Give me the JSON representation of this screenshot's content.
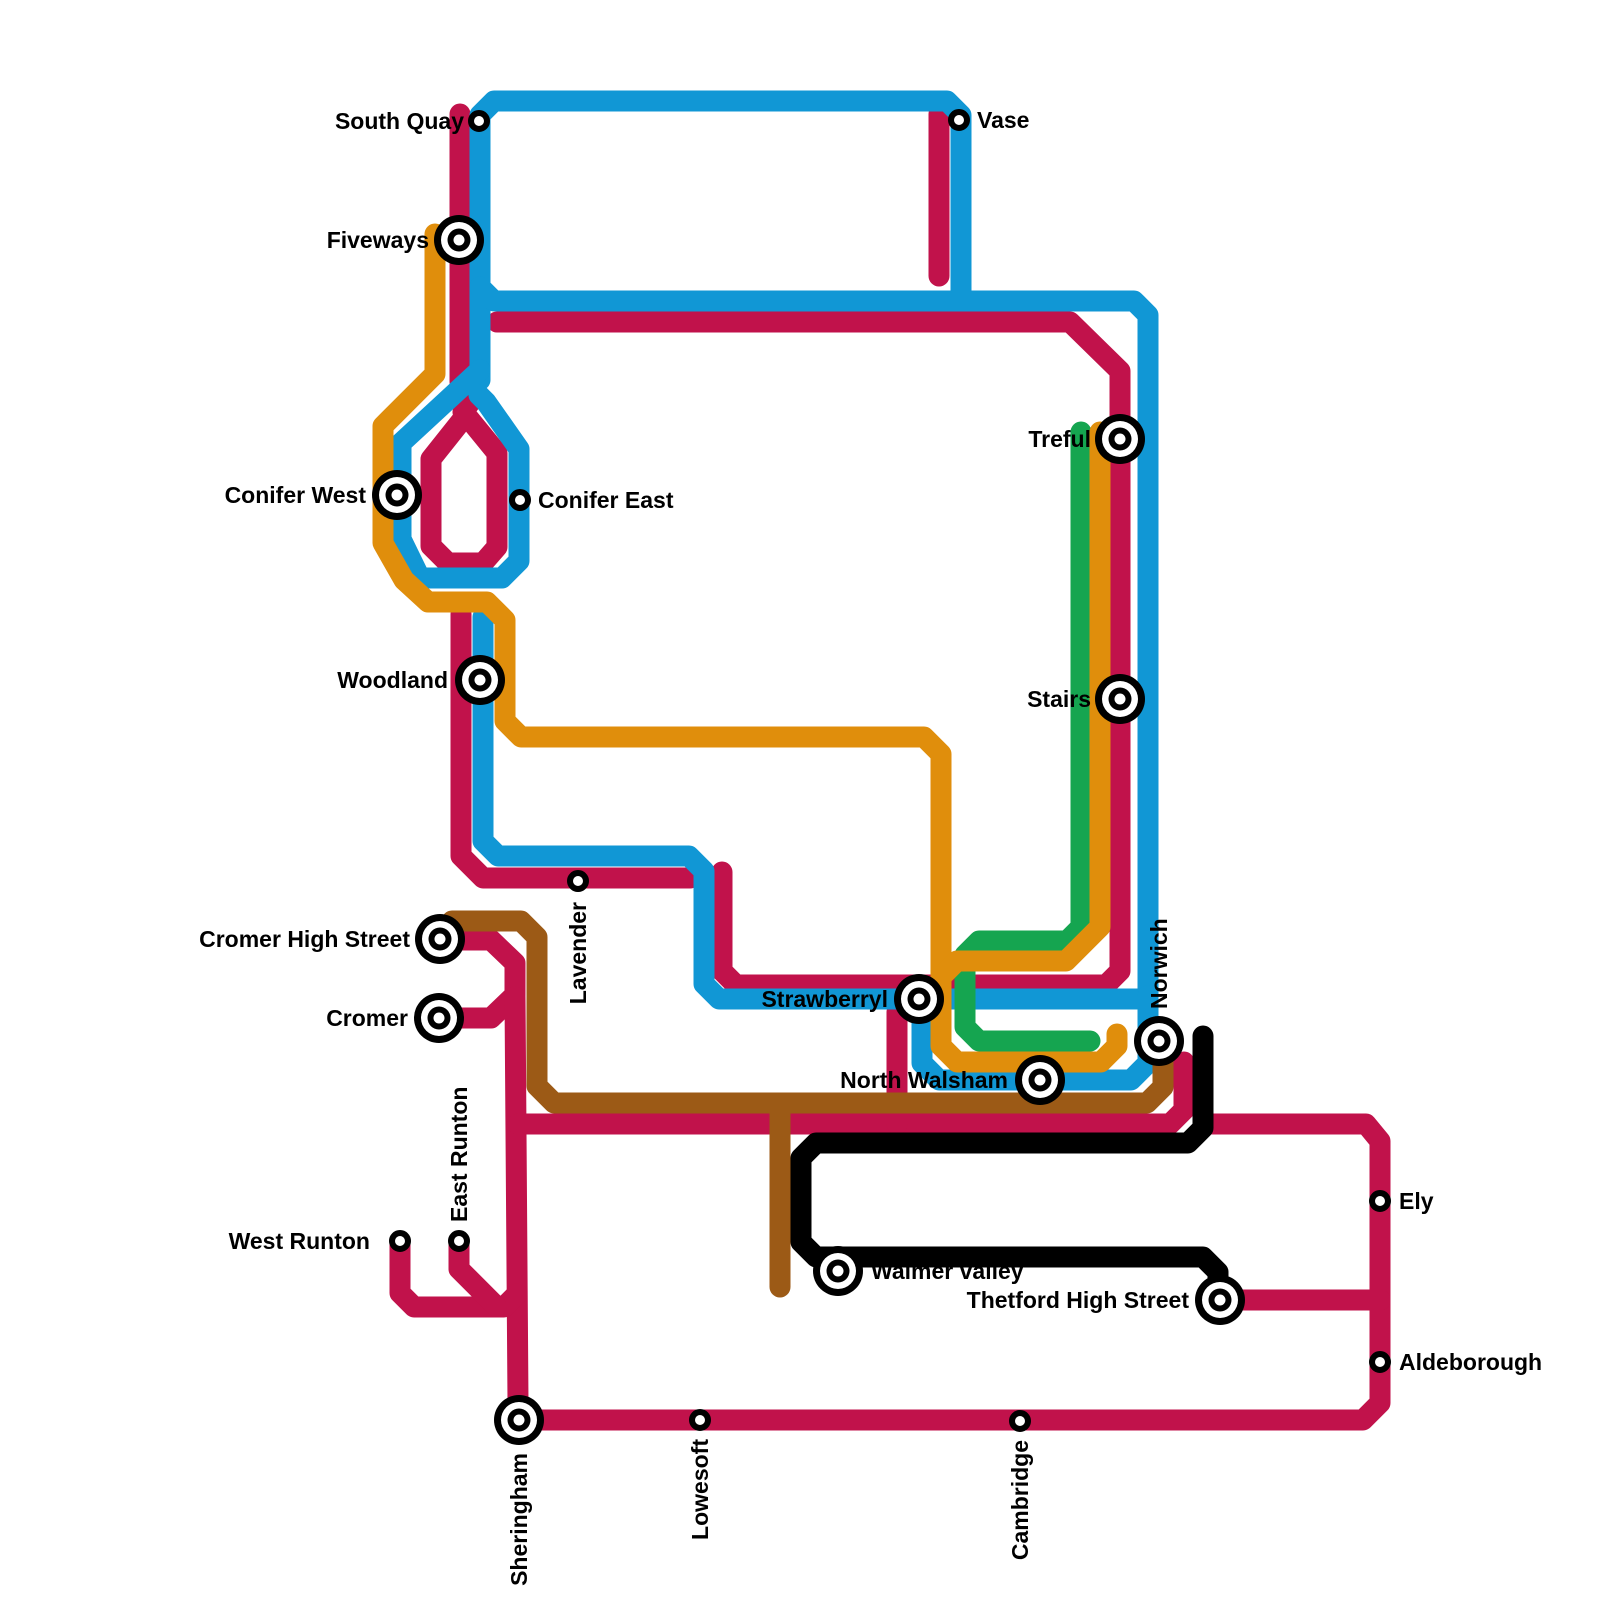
{
  "map": {
    "canvas": {
      "width": 1600,
      "height": 1600,
      "background": "#ffffff"
    },
    "line_width": 21,
    "label_font_size": 23,
    "colors": {
      "crimson": "#C1124B",
      "blue": "#1197D5",
      "orange": "#E08E0C",
      "green": "#15A550",
      "brown": "#9C5A16",
      "black": "#000000"
    },
    "lines": [
      {
        "name": "crimson-southquay-feed",
        "color": "crimson",
        "closed": false,
        "points": [
          [
            460,
            114
          ],
          [
            460,
            382
          ],
          [
            469,
            393
          ],
          [
            469,
            404
          ],
          [
            463,
            412
          ]
        ]
      },
      {
        "name": "crimson-conifer-loop",
        "color": "crimson",
        "closed": true,
        "points": [
          [
            466,
            415
          ],
          [
            497,
            453
          ],
          [
            497,
            547
          ],
          [
            483,
            563
          ],
          [
            448,
            563
          ],
          [
            431,
            546
          ],
          [
            431,
            459
          ]
        ]
      },
      {
        "name": "crimson-treful-strawberry",
        "color": "crimson",
        "closed": false,
        "points": [
          [
            497,
            322
          ],
          [
            1070,
            322
          ],
          [
            1120,
            371
          ],
          [
            1120,
            971
          ],
          [
            1106,
            985
          ],
          [
            736,
            985
          ],
          [
            722,
            971
          ],
          [
            722,
            872
          ]
        ]
      },
      {
        "name": "crimson-woodland-lavender",
        "color": "crimson",
        "closed": false,
        "points": [
          [
            461,
            614
          ],
          [
            461,
            856
          ],
          [
            483,
            878
          ],
          [
            690,
            878
          ]
        ]
      },
      {
        "name": "crimson-cromer-v",
        "color": "crimson",
        "closed": false,
        "points": [
          [
            446,
            940
          ],
          [
            491,
            940
          ],
          [
            515,
            963
          ],
          [
            515,
            995
          ],
          [
            491,
            1018
          ],
          [
            446,
            1018
          ]
        ]
      },
      {
        "name": "crimson-grand-loop",
        "color": "crimson",
        "closed": false,
        "points": [
          [
            515,
            997
          ],
          [
            518,
            1403
          ],
          [
            534,
            1420
          ],
          [
            1363,
            1420
          ],
          [
            1380,
            1403
          ],
          [
            1380,
            1141
          ],
          [
            1366,
            1124
          ],
          [
            1213,
            1124
          ]
        ]
      },
      {
        "name": "crimson-norwich-branch",
        "color": "crimson",
        "closed": false,
        "points": [
          [
            518,
            1124
          ],
          [
            1170,
            1124
          ],
          [
            1184,
            1110
          ],
          [
            1184,
            1062
          ]
        ]
      },
      {
        "name": "crimson-strawberry-stub",
        "color": "crimson",
        "closed": false,
        "points": [
          [
            897,
            1012
          ],
          [
            897,
            1124
          ]
        ]
      },
      {
        "name": "crimson-vase-stub",
        "color": "crimson",
        "closed": false,
        "points": [
          [
            939,
            114
          ],
          [
            939,
            276
          ]
        ]
      },
      {
        "name": "crimson-west-runton",
        "color": "crimson",
        "closed": false,
        "points": [
          [
            400,
            1241
          ],
          [
            400,
            1293
          ],
          [
            414,
            1307
          ],
          [
            504,
            1307
          ],
          [
            517,
            1294
          ]
        ]
      },
      {
        "name": "crimson-east-runton",
        "color": "crimson",
        "closed": false,
        "points": [
          [
            459,
            1241
          ],
          [
            459,
            1269
          ],
          [
            496,
            1306
          ]
        ]
      },
      {
        "name": "crimson-thetford-east",
        "color": "crimson",
        "closed": false,
        "points": [
          [
            1222,
            1300
          ],
          [
            1380,
            1300
          ]
        ]
      },
      {
        "name": "blue-top-rectangle",
        "color": "blue",
        "closed": false,
        "points": [
          [
            480,
            380
          ],
          [
            480,
            115
          ],
          [
            494,
            101
          ],
          [
            947,
            101
          ],
          [
            961,
            115
          ],
          [
            961,
            293
          ]
        ]
      },
      {
        "name": "blue-cross-town",
        "color": "blue",
        "closed": false,
        "points": [
          [
            480,
            287
          ],
          [
            494,
            301
          ],
          [
            1134,
            301
          ],
          [
            1148,
            315
          ],
          [
            1148,
            999
          ]
        ]
      },
      {
        "name": "blue-conifer-loop",
        "color": "blue",
        "closed": false,
        "points": [
          [
            480,
            370
          ],
          [
            401,
            443
          ],
          [
            401,
            539
          ],
          [
            420,
            578
          ],
          [
            502,
            578
          ],
          [
            519,
            561
          ],
          [
            519,
            449
          ],
          [
            486,
            402
          ],
          [
            479,
            395
          ]
        ]
      },
      {
        "name": "blue-woodland-strawberry",
        "color": "blue",
        "closed": false,
        "points": [
          [
            483,
            617
          ],
          [
            483,
            841
          ],
          [
            498,
            856
          ],
          [
            689,
            856
          ],
          [
            704,
            871
          ],
          [
            704,
            984
          ],
          [
            719,
            999
          ],
          [
            1141,
            999
          ]
        ]
      },
      {
        "name": "blue-north-walsham",
        "color": "blue",
        "closed": false,
        "points": [
          [
            922,
            1010
          ],
          [
            922,
            1063
          ],
          [
            939,
            1080
          ],
          [
            1131,
            1080
          ],
          [
            1148,
            1063
          ],
          [
            1148,
            996
          ]
        ]
      },
      {
        "name": "green-line",
        "color": "green",
        "closed": false,
        "points": [
          [
            1081,
            432
          ],
          [
            1081,
            927
          ],
          [
            1067,
            941
          ],
          [
            979,
            941
          ],
          [
            965,
            955
          ],
          [
            965,
            1027
          ],
          [
            979,
            1041
          ],
          [
            1090,
            1041
          ]
        ]
      },
      {
        "name": "orange-main",
        "color": "orange",
        "closed": false,
        "points": [
          [
            435,
            234
          ],
          [
            435,
            374
          ],
          [
            383,
            426
          ],
          [
            383,
            543
          ],
          [
            404,
            580
          ],
          [
            428,
            602
          ],
          [
            487,
            602
          ],
          [
            505,
            620
          ],
          [
            505,
            721
          ],
          [
            521,
            737
          ],
          [
            924,
            737
          ],
          [
            941,
            754
          ],
          [
            941,
            1046
          ],
          [
            957,
            1062
          ],
          [
            1101,
            1062
          ],
          [
            1117,
            1046
          ],
          [
            1117,
            1034
          ]
        ]
      },
      {
        "name": "orange-treful-branch",
        "color": "orange",
        "closed": false,
        "points": [
          [
            1100,
            432
          ],
          [
            1100,
            927
          ],
          [
            1066,
            961
          ],
          [
            957,
            961
          ],
          [
            941,
            977
          ]
        ]
      },
      {
        "name": "brown-main",
        "color": "brown",
        "closed": false,
        "points": [
          [
            452,
            921
          ],
          [
            521,
            921
          ],
          [
            537,
            937
          ],
          [
            537,
            1086
          ],
          [
            554,
            1103
          ],
          [
            1147,
            1103
          ],
          [
            1163,
            1087
          ],
          [
            1163,
            1058
          ]
        ]
      },
      {
        "name": "brown-walmer-branch",
        "color": "brown",
        "closed": false,
        "points": [
          [
            780,
            1103
          ],
          [
            780,
            1287
          ]
        ]
      },
      {
        "name": "black-line",
        "color": "black",
        "closed": false,
        "points": [
          [
            1203,
            1036
          ],
          [
            1203,
            1128
          ],
          [
            1188,
            1143
          ],
          [
            816,
            1143
          ],
          [
            801,
            1158
          ],
          [
            801,
            1242
          ],
          [
            816,
            1257
          ],
          [
            1203,
            1257
          ],
          [
            1218,
            1272
          ],
          [
            1218,
            1291
          ]
        ]
      }
    ],
    "stations": [
      {
        "name": "South Quay",
        "x": 479,
        "y": 121,
        "type": "small",
        "label": {
          "text": "South Quay",
          "x": 464,
          "y": 129,
          "anchor": "end",
          "rotate": 0
        }
      },
      {
        "name": "Vase",
        "x": 959,
        "y": 120,
        "type": "small",
        "label": {
          "text": "Vase",
          "x": 977,
          "y": 128,
          "anchor": "start",
          "rotate": 0
        }
      },
      {
        "name": "Fiveways",
        "x": 459,
        "y": 240,
        "type": "interchange",
        "label": {
          "text": "Fiveways",
          "x": 429,
          "y": 248,
          "anchor": "end",
          "rotate": 0
        }
      },
      {
        "name": "Treful",
        "x": 1120,
        "y": 439,
        "type": "interchange",
        "label": {
          "text": "Treful",
          "x": 1091,
          "y": 447,
          "anchor": "end",
          "rotate": 0
        }
      },
      {
        "name": "Conifer West",
        "x": 397,
        "y": 495,
        "type": "interchange",
        "label": {
          "text": "Conifer West",
          "x": 366,
          "y": 503,
          "anchor": "end",
          "rotate": 0
        }
      },
      {
        "name": "Conifer East",
        "x": 520,
        "y": 500,
        "type": "small",
        "label": {
          "text": "Conifer East",
          "x": 538,
          "y": 508,
          "anchor": "start",
          "rotate": 0
        }
      },
      {
        "name": "Woodland",
        "x": 480,
        "y": 680,
        "type": "interchange",
        "label": {
          "text": "Woodland",
          "x": 448,
          "y": 688,
          "anchor": "end",
          "rotate": 0
        }
      },
      {
        "name": "Stairs",
        "x": 1120,
        "y": 699,
        "type": "interchange",
        "label": {
          "text": "Stairs",
          "x": 1091,
          "y": 707,
          "anchor": "end",
          "rotate": 0
        }
      },
      {
        "name": "Lavender",
        "x": 578,
        "y": 881,
        "type": "small",
        "label": {
          "text": "Lavender",
          "x": 586,
          "y": 902,
          "anchor": "end",
          "rotate": -90
        }
      },
      {
        "name": "Cromer High Street",
        "x": 440,
        "y": 939,
        "type": "interchange",
        "label": {
          "text": "Cromer High Street",
          "x": 410,
          "y": 947,
          "anchor": "end",
          "rotate": 0
        }
      },
      {
        "name": "Cromer",
        "x": 439,
        "y": 1018,
        "type": "interchange",
        "label": {
          "text": "Cromer",
          "x": 408,
          "y": 1026,
          "anchor": "end",
          "rotate": 0
        }
      },
      {
        "name": "Strawberryl",
        "x": 919,
        "y": 999,
        "type": "interchange",
        "label": {
          "text": "Strawberryl",
          "x": 888,
          "y": 1007,
          "anchor": "end",
          "rotate": 0
        }
      },
      {
        "name": "Norwich",
        "x": 1159,
        "y": 1041,
        "type": "interchange",
        "label": {
          "text": "Norwich",
          "x": 1167,
          "y": 1009,
          "anchor": "start",
          "rotate": -90
        }
      },
      {
        "name": "North Walsham",
        "x": 1040,
        "y": 1080,
        "type": "interchange",
        "label": {
          "text": "North Walsham",
          "x": 1008,
          "y": 1088,
          "anchor": "end",
          "rotate": 0
        }
      },
      {
        "name": "West Runton",
        "x": 400,
        "y": 1241,
        "type": "small",
        "label": {
          "text": "West Runton",
          "x": 370,
          "y": 1249,
          "anchor": "end",
          "rotate": 0
        }
      },
      {
        "name": "East Runton",
        "x": 459,
        "y": 1241,
        "type": "small",
        "label": {
          "text": "East Runton",
          "x": 467,
          "y": 1222,
          "anchor": "start",
          "rotate": -90
        }
      },
      {
        "name": "Walmer valley",
        "x": 838,
        "y": 1271,
        "type": "interchange",
        "label": {
          "text": "Walmer valley",
          "x": 871,
          "y": 1279,
          "anchor": "start",
          "rotate": 0
        }
      },
      {
        "name": "Thetford High Street",
        "x": 1220,
        "y": 1300,
        "type": "interchange",
        "label": {
          "text": "Thetford High Street",
          "x": 1189,
          "y": 1308,
          "anchor": "end",
          "rotate": 0
        }
      },
      {
        "name": "Ely",
        "x": 1380,
        "y": 1201,
        "type": "small",
        "label": {
          "text": "Ely",
          "x": 1399,
          "y": 1209,
          "anchor": "start",
          "rotate": 0
        }
      },
      {
        "name": "Aldeborough",
        "x": 1380,
        "y": 1362,
        "type": "small",
        "label": {
          "text": "Aldeborough",
          "x": 1399,
          "y": 1370,
          "anchor": "start",
          "rotate": 0
        }
      },
      {
        "name": "Sheringham",
        "x": 519,
        "y": 1420,
        "type": "interchange",
        "label": {
          "text": "Sheringham",
          "x": 527,
          "y": 1453,
          "anchor": "end",
          "rotate": -90
        }
      },
      {
        "name": "Lowesoft",
        "x": 700,
        "y": 1420,
        "type": "small",
        "label": {
          "text": "Lowesoft",
          "x": 708,
          "y": 1439,
          "anchor": "end",
          "rotate": -90
        }
      },
      {
        "name": "Cambridge",
        "x": 1020,
        "y": 1421,
        "type": "small",
        "label": {
          "text": "Cambridge",
          "x": 1028,
          "y": 1440,
          "anchor": "end",
          "rotate": -90
        }
      }
    ],
    "station_style": {
      "small": {
        "radius": 8,
        "ring": 6
      },
      "interchange": {
        "outer": 25,
        "white1": 18,
        "inner": 11.5,
        "core": 5.5
      }
    }
  }
}
